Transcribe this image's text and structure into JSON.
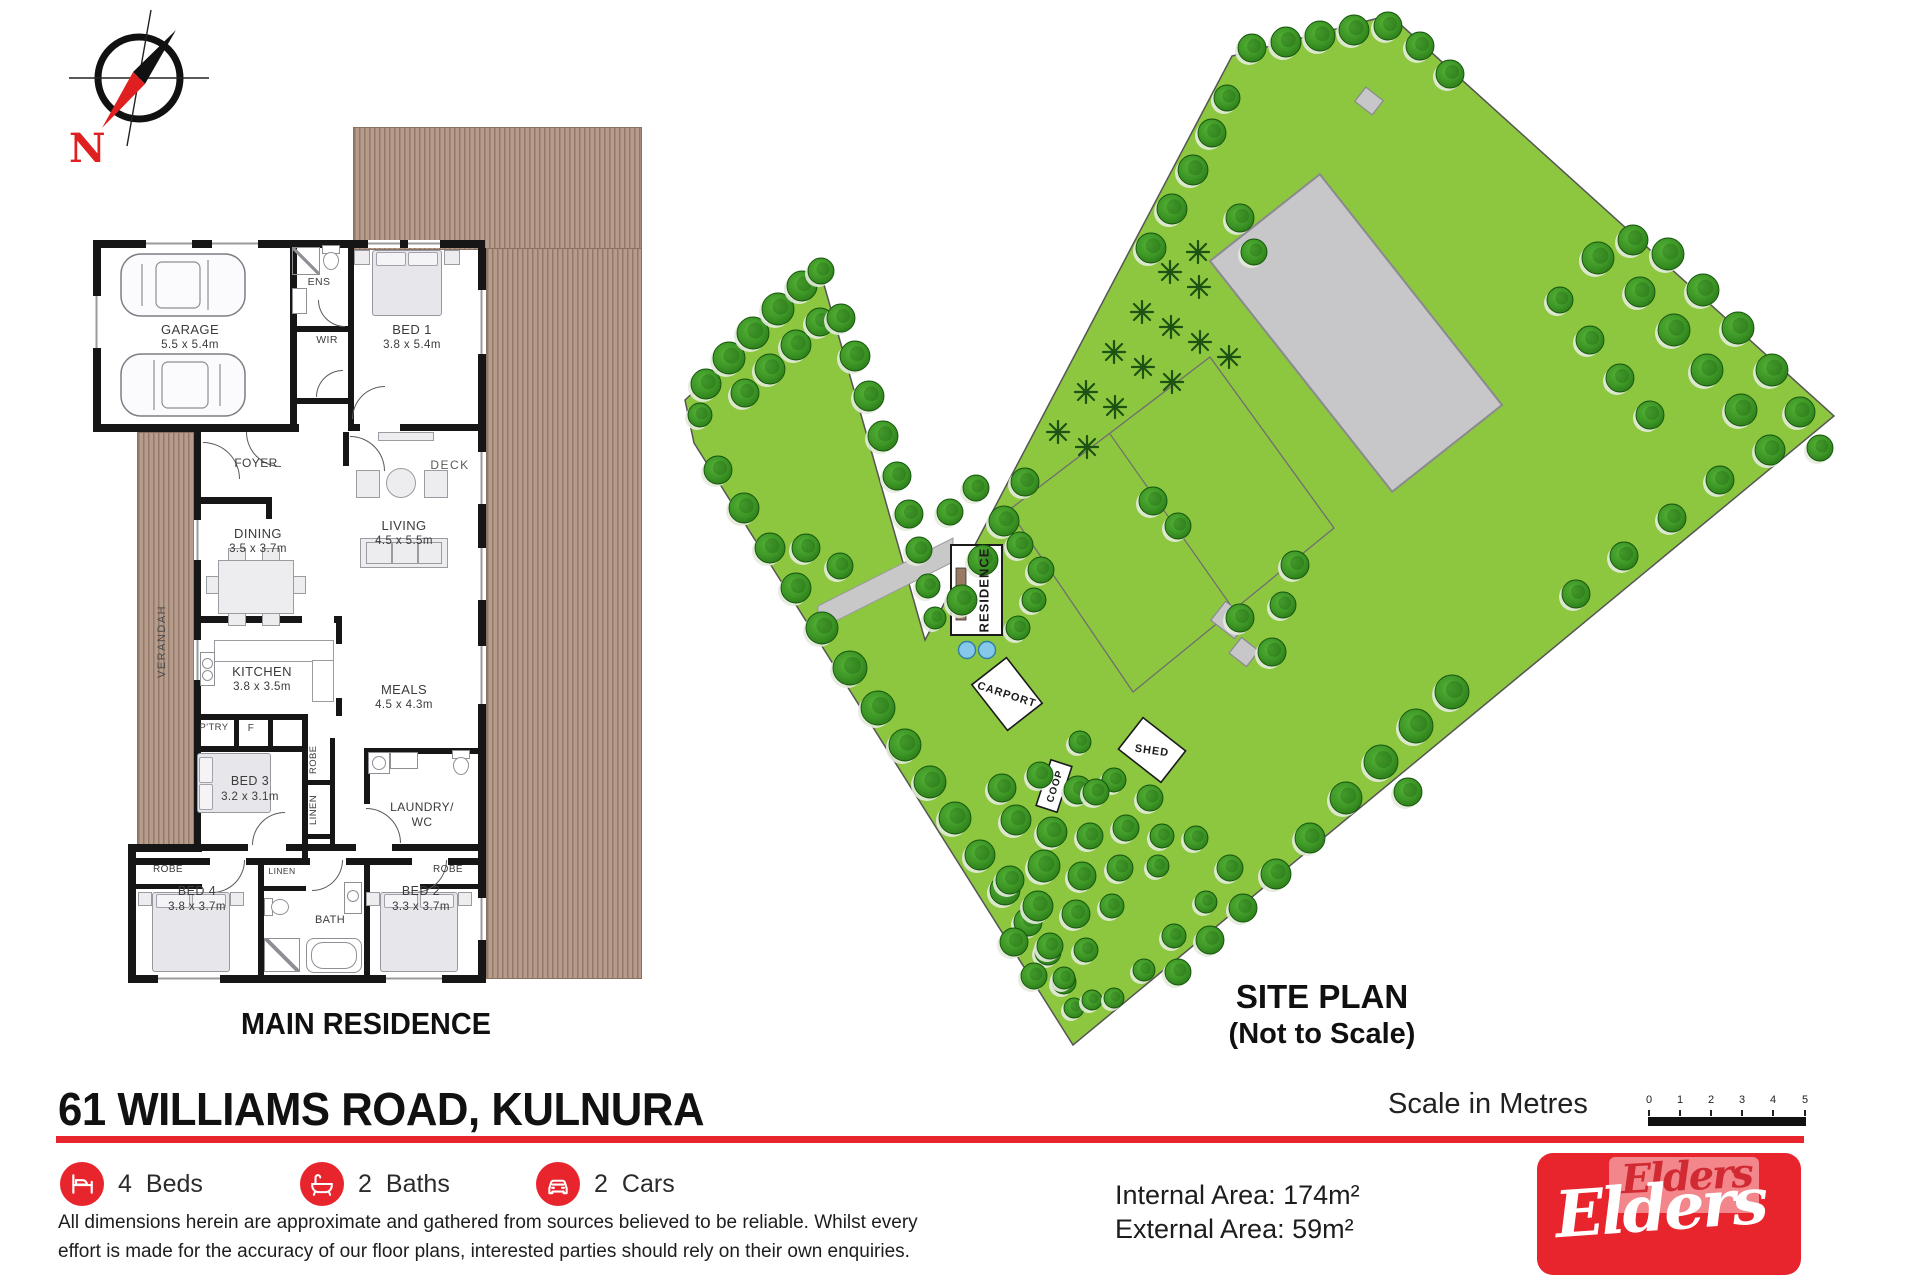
{
  "compass": {
    "label": "N"
  },
  "floor_plan": {
    "caption": "MAIN RESIDENCE",
    "rooms": {
      "garage": {
        "name": "GARAGE",
        "dims": "5.5 x 5.4m"
      },
      "ens": {
        "name": "ENS"
      },
      "wir": {
        "name": "WIR"
      },
      "bed1": {
        "name": "BED 1",
        "dims": "3.8 x 5.4m"
      },
      "foyer": {
        "name": "FOYER"
      },
      "dining": {
        "name": "DINING",
        "dims": "3.5 x 3.7m"
      },
      "living": {
        "name": "LIVING",
        "dims": "4.5 x 5.5m"
      },
      "deck": {
        "name": "DECK"
      },
      "verandah": {
        "name": "VERANDAH"
      },
      "kitchen": {
        "name": "KITCHEN",
        "dims": "3.8 x 3.5m"
      },
      "meals": {
        "name": "MEALS",
        "dims": "4.5 x 4.3m"
      },
      "pantry": {
        "name": "P'TRY"
      },
      "fridge": {
        "name": "F"
      },
      "robe_bed3": {
        "name": "ROBE"
      },
      "bed3": {
        "name": "BED 3",
        "dims": "3.2 x 3.1m"
      },
      "linen_hall": {
        "name": "LINEN"
      },
      "laundry": {
        "name": "LAUNDRY/",
        "name2": "WC"
      },
      "robe_bed4": {
        "name": "ROBE"
      },
      "bed4": {
        "name": "BED 4",
        "dims": "3.8 x 3.7m"
      },
      "linen_bath": {
        "name": "LINEN"
      },
      "bath": {
        "name": "BATH"
      },
      "bed2": {
        "name": "BED 2",
        "dims": "3.3 x 3.7m"
      },
      "robe_bed2": {
        "name": "ROBE"
      }
    }
  },
  "site_plan": {
    "caption_line1": "SITE PLAN",
    "caption_line2": "(Not to Scale)",
    "labels": {
      "residence": "RESIDENCE",
      "carport": "CARPORT",
      "shed": "SHED",
      "coop": "COOP"
    },
    "colors": {
      "grass": "#8dc63f",
      "edge": "#555555",
      "tree_mid": "#49a52c",
      "tree_dark": "#2a7a17",
      "tree_stroke": "#14540c",
      "palm": "#1c5212",
      "building": "#c7c7c9",
      "building_edge": "#8a8a8e",
      "fence": "#6f6f6f",
      "drive": "#c8c8c8",
      "tank": "#86c8ea",
      "tank_edge": "#2e7ea8",
      "res_deck": "#9b7a64"
    },
    "boundary": [
      [
        685,
        400
      ],
      [
        821,
        274
      ],
      [
        925,
        640
      ],
      [
        1232,
        56
      ],
      [
        1390,
        15
      ],
      [
        1834,
        416
      ],
      [
        1073,
        1045
      ],
      [
        694,
        443
      ]
    ],
    "paddock": {
      "pts": "1009,510 1210,357 1334,528 1133,692",
      "divider": [
        1110,
        434,
        1234,
        610
      ]
    },
    "big_shed": {
      "cx": 1356,
      "cy": 333,
      "w": 140,
      "h": 294,
      "angle": -38.3
    },
    "small_rects": [
      {
        "cx": 1369,
        "cy": 101,
        "w": 22,
        "h": 18,
        "angle": 38
      },
      {
        "cx": 1230,
        "cy": 620,
        "w": 30,
        "h": 24,
        "angle": 38
      },
      {
        "cx": 1244,
        "cy": 652,
        "w": 22,
        "h": 20,
        "angle": 38
      }
    ],
    "driveway": "818,606 953,538 953,562 818,630",
    "residence": {
      "x": 951,
      "y": 545,
      "w": 51,
      "h": 90,
      "deck": [
        956,
        568,
        10,
        52
      ]
    },
    "tanks": [
      [
        967,
        650,
        8.5
      ],
      [
        987,
        650,
        8.5
      ]
    ],
    "carport": {
      "cx": 1007,
      "cy": 694,
      "w": 58,
      "h": 44,
      "angle": 52,
      "text_angle": 18
    },
    "shed": {
      "cx": 1152,
      "cy": 750,
      "w": 54,
      "h": 40,
      "angle": 38,
      "text_angle": 8
    },
    "coop": {
      "cx": 1054,
      "cy": 786,
      "w": 22,
      "h": 48,
      "angle": 18,
      "text_angle": -72
    },
    "palms": [
      [
        1058,
        432
      ],
      [
        1087,
        447
      ],
      [
        1086,
        392
      ],
      [
        1115,
        407
      ],
      [
        1114,
        352
      ],
      [
        1143,
        367
      ],
      [
        1142,
        312
      ],
      [
        1171,
        327
      ],
      [
        1170,
        272
      ],
      [
        1199,
        287
      ],
      [
        1200,
        342
      ],
      [
        1172,
        382
      ],
      [
        1229,
        357
      ],
      [
        1198,
        252
      ]
    ],
    "trees": [
      [
        706,
        384,
        15
      ],
      [
        729,
        358,
        16
      ],
      [
        753,
        333,
        16
      ],
      [
        778,
        309,
        16
      ],
      [
        802,
        286,
        15
      ],
      [
        821,
        271,
        13
      ],
      [
        700,
        415,
        12
      ],
      [
        745,
        393,
        14
      ],
      [
        770,
        369,
        15
      ],
      [
        796,
        345,
        15
      ],
      [
        820,
        322,
        14
      ],
      [
        841,
        318,
        14
      ],
      [
        855,
        356,
        15
      ],
      [
        869,
        396,
        15
      ],
      [
        883,
        436,
        15
      ],
      [
        897,
        476,
        14
      ],
      [
        909,
        514,
        14
      ],
      [
        919,
        550,
        13
      ],
      [
        928,
        586,
        12
      ],
      [
        935,
        618,
        11
      ],
      [
        962,
        600,
        15
      ],
      [
        983,
        560,
        15
      ],
      [
        1004,
        521,
        15
      ],
      [
        1025,
        482,
        14
      ],
      [
        1151,
        248,
        15
      ],
      [
        1172,
        209,
        15
      ],
      [
        1193,
        170,
        15
      ],
      [
        1212,
        133,
        14
      ],
      [
        1227,
        98,
        13
      ],
      [
        1240,
        218,
        14
      ],
      [
        1254,
        252,
        13
      ],
      [
        1252,
        48,
        14
      ],
      [
        1286,
        42,
        15
      ],
      [
        1320,
        36,
        15
      ],
      [
        1354,
        30,
        15
      ],
      [
        1388,
        26,
        14
      ],
      [
        1420,
        46,
        14
      ],
      [
        1450,
        74,
        14
      ],
      [
        1598,
        258,
        16
      ],
      [
        1633,
        240,
        15
      ],
      [
        1668,
        254,
        16
      ],
      [
        1640,
        292,
        15
      ],
      [
        1703,
        290,
        16
      ],
      [
        1674,
        330,
        16
      ],
      [
        1738,
        328,
        16
      ],
      [
        1707,
        370,
        16
      ],
      [
        1772,
        370,
        16
      ],
      [
        1741,
        410,
        16
      ],
      [
        1800,
        412,
        15
      ],
      [
        1770,
        450,
        15
      ],
      [
        1820,
        448,
        13
      ],
      [
        1560,
        300,
        13
      ],
      [
        1590,
        340,
        14
      ],
      [
        1620,
        378,
        14
      ],
      [
        1650,
        415,
        14
      ],
      [
        1720,
        480,
        14
      ],
      [
        1672,
        518,
        14
      ],
      [
        1624,
        556,
        14
      ],
      [
        1576,
        594,
        14
      ],
      [
        1452,
        692,
        17
      ],
      [
        1416,
        726,
        17
      ],
      [
        1381,
        762,
        17
      ],
      [
        1346,
        798,
        16
      ],
      [
        1408,
        792,
        14
      ],
      [
        1310,
        838,
        15
      ],
      [
        1276,
        874,
        15
      ],
      [
        1243,
        908,
        14
      ],
      [
        1210,
        940,
        14
      ],
      [
        1178,
        972,
        13
      ],
      [
        718,
        470,
        14
      ],
      [
        744,
        508,
        15
      ],
      [
        770,
        548,
        15
      ],
      [
        796,
        588,
        15
      ],
      [
        822,
        628,
        16
      ],
      [
        850,
        668,
        17
      ],
      [
        878,
        708,
        17
      ],
      [
        905,
        745,
        16
      ],
      [
        930,
        782,
        16
      ],
      [
        955,
        818,
        16
      ],
      [
        980,
        855,
        15
      ],
      [
        1005,
        890,
        15
      ],
      [
        1028,
        922,
        14
      ],
      [
        1048,
        952,
        13
      ],
      [
        1064,
        982,
        12
      ],
      [
        1074,
        1008,
        10
      ],
      [
        1002,
        788,
        14
      ],
      [
        1040,
        775,
        13
      ],
      [
        1078,
        790,
        14
      ],
      [
        1114,
        780,
        12
      ],
      [
        1150,
        798,
        13
      ],
      [
        1016,
        820,
        15
      ],
      [
        1052,
        832,
        15
      ],
      [
        1090,
        836,
        13
      ],
      [
        1126,
        828,
        13
      ],
      [
        1162,
        836,
        12
      ],
      [
        1044,
        866,
        16
      ],
      [
        1082,
        876,
        14
      ],
      [
        1120,
        868,
        13
      ],
      [
        1158,
        866,
        11
      ],
      [
        1010,
        880,
        14
      ],
      [
        1038,
        906,
        15
      ],
      [
        1076,
        914,
        14
      ],
      [
        1112,
        906,
        12
      ],
      [
        1014,
        942,
        14
      ],
      [
        1050,
        946,
        13
      ],
      [
        1086,
        950,
        12
      ],
      [
        1034,
        976,
        13
      ],
      [
        1064,
        978,
        11
      ],
      [
        1092,
        1000,
        10
      ],
      [
        1196,
        838,
        12
      ],
      [
        1230,
        868,
        13
      ],
      [
        1206,
        902,
        11
      ],
      [
        1174,
        936,
        12
      ],
      [
        1144,
        970,
        11
      ],
      [
        1114,
        998,
        10
      ],
      [
        806,
        548,
        14
      ],
      [
        840,
        566,
        13
      ],
      [
        1020,
        545,
        13
      ],
      [
        1041,
        570,
        13
      ],
      [
        1034,
        600,
        12
      ],
      [
        1018,
        628,
        12
      ],
      [
        950,
        512,
        13
      ],
      [
        976,
        488,
        13
      ],
      [
        1080,
        742,
        11
      ],
      [
        1096,
        792,
        13
      ],
      [
        1153,
        501,
        14
      ],
      [
        1178,
        526,
        13
      ],
      [
        1240,
        618,
        14
      ],
      [
        1272,
        652,
        14
      ],
      [
        1295,
        565,
        14
      ],
      [
        1283,
        605,
        13
      ]
    ]
  },
  "footer": {
    "title": "61 WILLIAMS ROAD, KULNURA",
    "features": [
      {
        "count": "4",
        "label": "Beds"
      },
      {
        "count": "2",
        "label": "Baths"
      },
      {
        "count": "2",
        "label": "Cars"
      }
    ],
    "disclaimer": {
      "line1": "All dimensions herein are approximate and gathered from sources believed to be reliable. Whilst every",
      "line2": "effort is made for the accuracy of our floor plans, interested parties should rely on their own enquiries."
    },
    "areas": {
      "internal": "Internal Area: 174m²",
      "external": "External Area: 59m²"
    },
    "scale": {
      "label": "Scale in Metres",
      "ticks": [
        "0",
        "1",
        "2",
        "3",
        "4",
        "5"
      ]
    },
    "brand": {
      "name": "Elders",
      "color": "#e8242c"
    }
  }
}
